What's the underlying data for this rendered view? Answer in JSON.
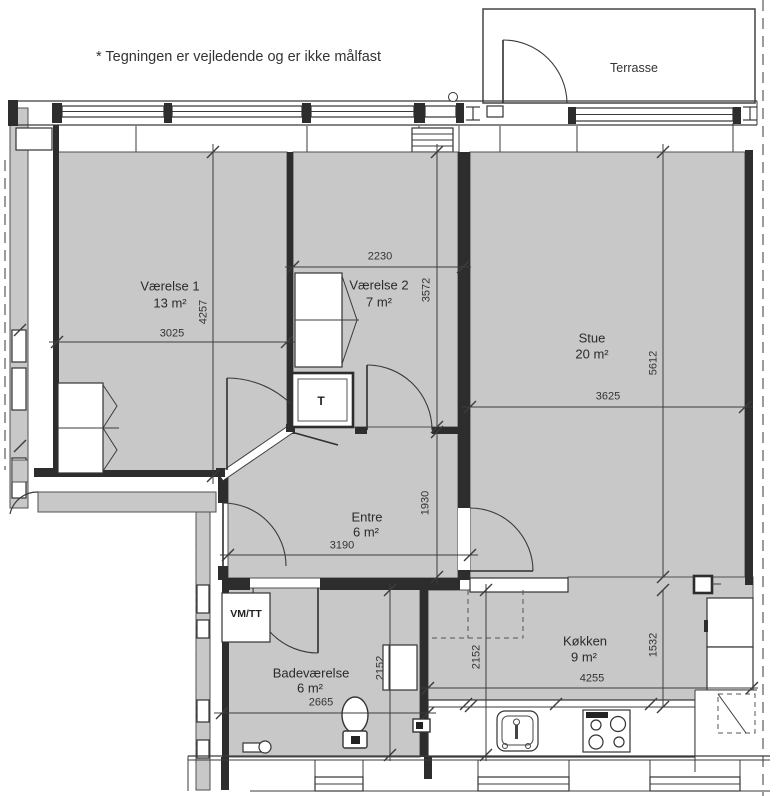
{
  "disclaimer": "* Tegningen er vejledende og er ikke målfast",
  "terrace": {
    "label": "Terrasse"
  },
  "rooms": [
    {
      "id": "vaerelse1",
      "name": "Værelse 1",
      "area": "13 m²",
      "width_mm": "3025",
      "height_mm": "4257"
    },
    {
      "id": "vaerelse2",
      "name": "Værelse 2",
      "area": "7 m²",
      "width_mm": "2230",
      "height_mm": "3572"
    },
    {
      "id": "stue",
      "name": "Stue",
      "area": "20 m²",
      "width_mm": "3625",
      "height_mm": "5612"
    },
    {
      "id": "entre",
      "name": "Entre",
      "area": "6 m²",
      "width_mm": "3190",
      "height_mm": "1930"
    },
    {
      "id": "badevaerelse",
      "name": "Badeværelse",
      "area": "6 m²",
      "width_mm": "2665",
      "height_mm": "2152"
    },
    {
      "id": "koekken",
      "name": "Køkken",
      "area": "9 m²",
      "width_mm": "4255",
      "height_mm": "1532",
      "left_mm": "2152"
    }
  ],
  "fixtures": {
    "tech_closet": "T",
    "washer_dryer": "VM/TT"
  },
  "colors": {
    "room_fill": "#c8c8c8",
    "wall": "#2d2d2d",
    "dashed": "#7a7a7a",
    "background": "#ffffff"
  }
}
